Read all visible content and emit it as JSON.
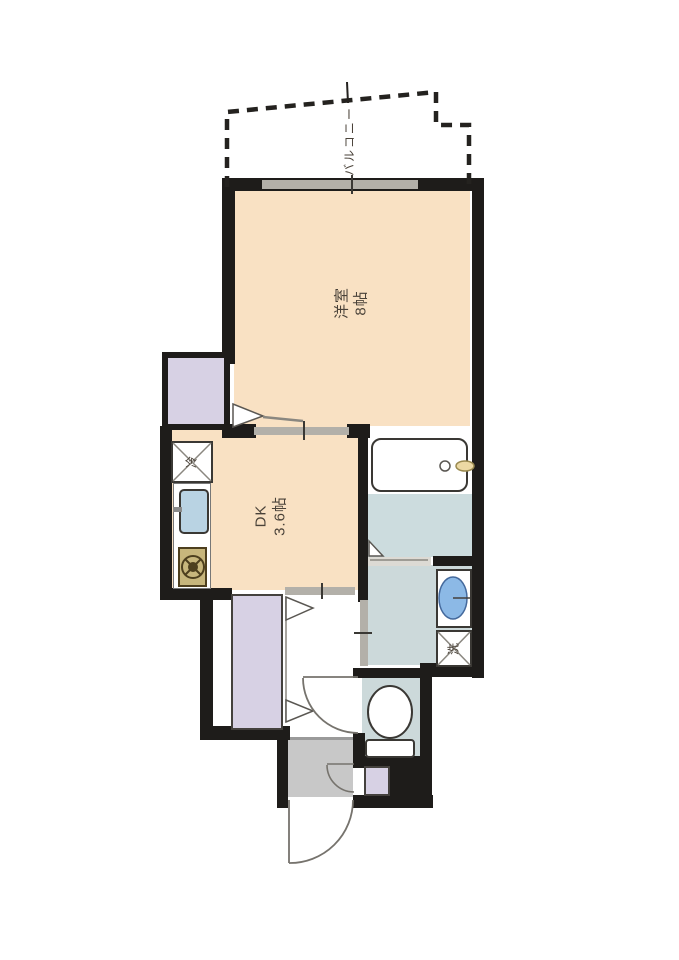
{
  "plan_type": "apartment-floor-plan",
  "balcony": {
    "label": "バルコニー"
  },
  "rooms": [
    {
      "name": "洋室",
      "size": "8帖"
    },
    {
      "name": "DK",
      "size": "3.6帖"
    }
  ],
  "appliance_marks": {
    "refrigerator": "冷",
    "washing_machine": "洗"
  },
  "fixtures": [
    "closet",
    "hall-closet",
    "refrigerator-space",
    "kitchen-sink",
    "gas-stove",
    "bathtub",
    "washbasin",
    "washing-machine-space",
    "toilet",
    "shoe-cabinet",
    "entry-door",
    "toilet-door",
    "sliding-doors",
    "window",
    "balcony-outline"
  ],
  "colors": {
    "wall": "#1e1c1a",
    "room_floor": "#f9e1c3",
    "closet": "#d7d1e4",
    "wet_area_floor": "#ccd9da",
    "genkan_floor": "#c8c8c8",
    "fixture_blue": "#8cb9e6",
    "sink_blue": "#b9d3e3",
    "stove_tan": "#c7b67c",
    "slider_gray": "#b3b0a9"
  }
}
